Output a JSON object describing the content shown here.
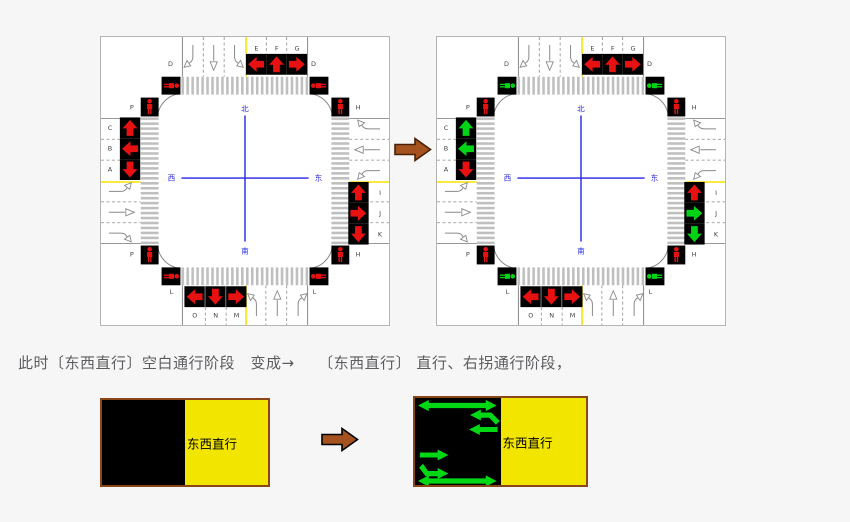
{
  "background": "#f6f6f6",
  "caption": {
    "text": "此时〔东西直行〕空白通行阶段　变成→　　〔东西直行〕 直行、右拐通行阶段，",
    "color": "#5c5c60"
  },
  "colors": {
    "red": "#e81111",
    "green": "#00d414",
    "phase_arrow_green": "#00d816",
    "black": "#000000",
    "road_line": "#8a8a8a",
    "stripe": "#bfbfbf",
    "yellow_line": "#f8e400",
    "blue": "#2424e0",
    "letter": "#3f3f3f",
    "diagram_bg": "#ffffff",
    "diagram_border": "#b4b4b4",
    "brown_arrow": "#a5531e",
    "brown_arrow_outline": "#4a2106",
    "phase_yellow": "#f2e600",
    "phase_border": "#8a4616",
    "phase_label_color": "#000000"
  },
  "labels": {
    "north_signal_letters": [
      "E",
      "F",
      "G"
    ],
    "north_road_letters": [
      "D",
      "D"
    ],
    "west_signal_letters": [
      "C",
      "B",
      "A"
    ],
    "east_signal_letters": [
      "I",
      "J",
      "K"
    ],
    "south_signal_letters": [
      "O",
      "N",
      "M"
    ],
    "south_road_letters": [
      "L",
      "L"
    ],
    "corner_letters": {
      "nw": "P",
      "sw": "P",
      "ne": "H",
      "se": "H"
    },
    "compass": {
      "north": "北",
      "south": "南",
      "east": "东",
      "west": "西"
    }
  },
  "signal_directions": {
    "north": [
      "left",
      "up",
      "right"
    ],
    "west": [
      "up",
      "left",
      "down"
    ],
    "east": [
      "up",
      "right",
      "down"
    ],
    "south": [
      "left",
      "down",
      "right"
    ]
  },
  "diagrams": [
    {
      "id": "before",
      "signal_colors": {
        "north": [
          "red",
          "red",
          "red"
        ],
        "west": [
          "red",
          "red",
          "red"
        ],
        "east": [
          "red",
          "red",
          "red"
        ],
        "south": [
          "red",
          "red",
          "red"
        ]
      },
      "pedestrian_horizontal_crosswalks": "red",
      "pedestrian_vertical_crosswalks": "red"
    },
    {
      "id": "after",
      "signal_colors": {
        "north": [
          "red",
          "red",
          "red"
        ],
        "west": [
          "green",
          "green",
          "red"
        ],
        "east": [
          "red",
          "green",
          "green"
        ],
        "south": [
          "red",
          "red",
          "red"
        ]
      },
      "pedestrian_horizontal_crosswalks": "green",
      "pedestrian_vertical_crosswalks": "red"
    }
  ],
  "phase_boxes": [
    {
      "label": "东西直行",
      "arrows": []
    },
    {
      "label": "东西直行",
      "arrows": [
        "double-headed-horizontal-arrow",
        "left-hook-arrow",
        "left-arrow",
        "right-arrow",
        "right-hook-arrow",
        "double-headed-horizontal-arrow"
      ]
    }
  ]
}
